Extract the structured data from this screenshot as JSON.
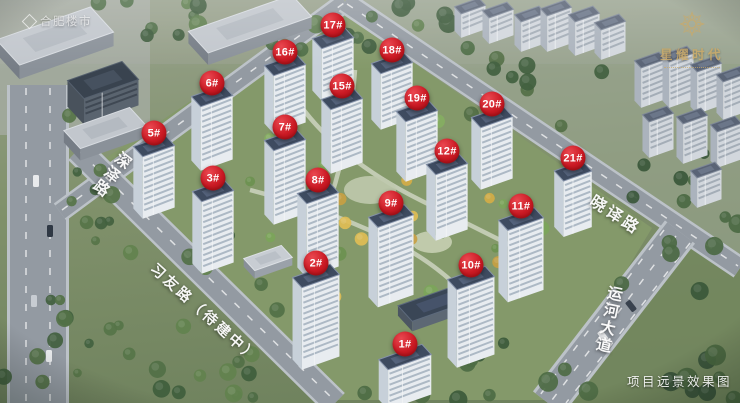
{
  "watermarks": {
    "top_left_logo": "合肥楼市",
    "top_right_title": "星耀时代",
    "caption": "项目远景效果图"
  },
  "colors": {
    "badge_red": "#cb1a24",
    "brand_gold": "#cbaa68",
    "road_label": "#ffffff"
  },
  "road_labels": [
    {
      "id": "shenze",
      "label": "深泽路",
      "x": 118,
      "y": 146,
      "rotate": 38,
      "vertical": true,
      "size": 15.5
    },
    {
      "id": "xiyou",
      "label": "习友路（待建中）",
      "x": 160,
      "y": 258,
      "rotate": 42,
      "vertical": false,
      "size": 14.5
    },
    {
      "id": "xiaoyi",
      "label": "晓译路",
      "x": 599,
      "y": 188,
      "rotate": 33,
      "vertical": false,
      "size": 16
    },
    {
      "id": "yunhe",
      "label": "运河大道",
      "x": 604,
      "y": 283,
      "rotate": 12,
      "vertical": true,
      "size": 15.5
    }
  ],
  "building_markers": [
    {
      "label": "1#",
      "x": 405,
      "y": 344
    },
    {
      "label": "2#",
      "x": 316,
      "y": 263
    },
    {
      "label": "3#",
      "x": 213,
      "y": 178
    },
    {
      "label": "5#",
      "x": 154,
      "y": 133
    },
    {
      "label": "6#",
      "x": 212,
      "y": 83
    },
    {
      "label": "7#",
      "x": 285,
      "y": 127
    },
    {
      "label": "8#",
      "x": 318,
      "y": 180
    },
    {
      "label": "9#",
      "x": 391,
      "y": 203
    },
    {
      "label": "10#",
      "x": 471,
      "y": 265
    },
    {
      "label": "11#",
      "x": 521,
      "y": 206
    },
    {
      "label": "12#",
      "x": 447,
      "y": 151
    },
    {
      "label": "15#",
      "x": 342,
      "y": 86
    },
    {
      "label": "16#",
      "x": 285,
      "y": 52
    },
    {
      "label": "17#",
      "x": 333,
      "y": 25
    },
    {
      "label": "18#",
      "x": 392,
      "y": 50
    },
    {
      "label": "19#",
      "x": 417,
      "y": 98
    },
    {
      "label": "20#",
      "x": 492,
      "y": 104
    },
    {
      "label": "21#",
      "x": 573,
      "y": 158
    }
  ]
}
